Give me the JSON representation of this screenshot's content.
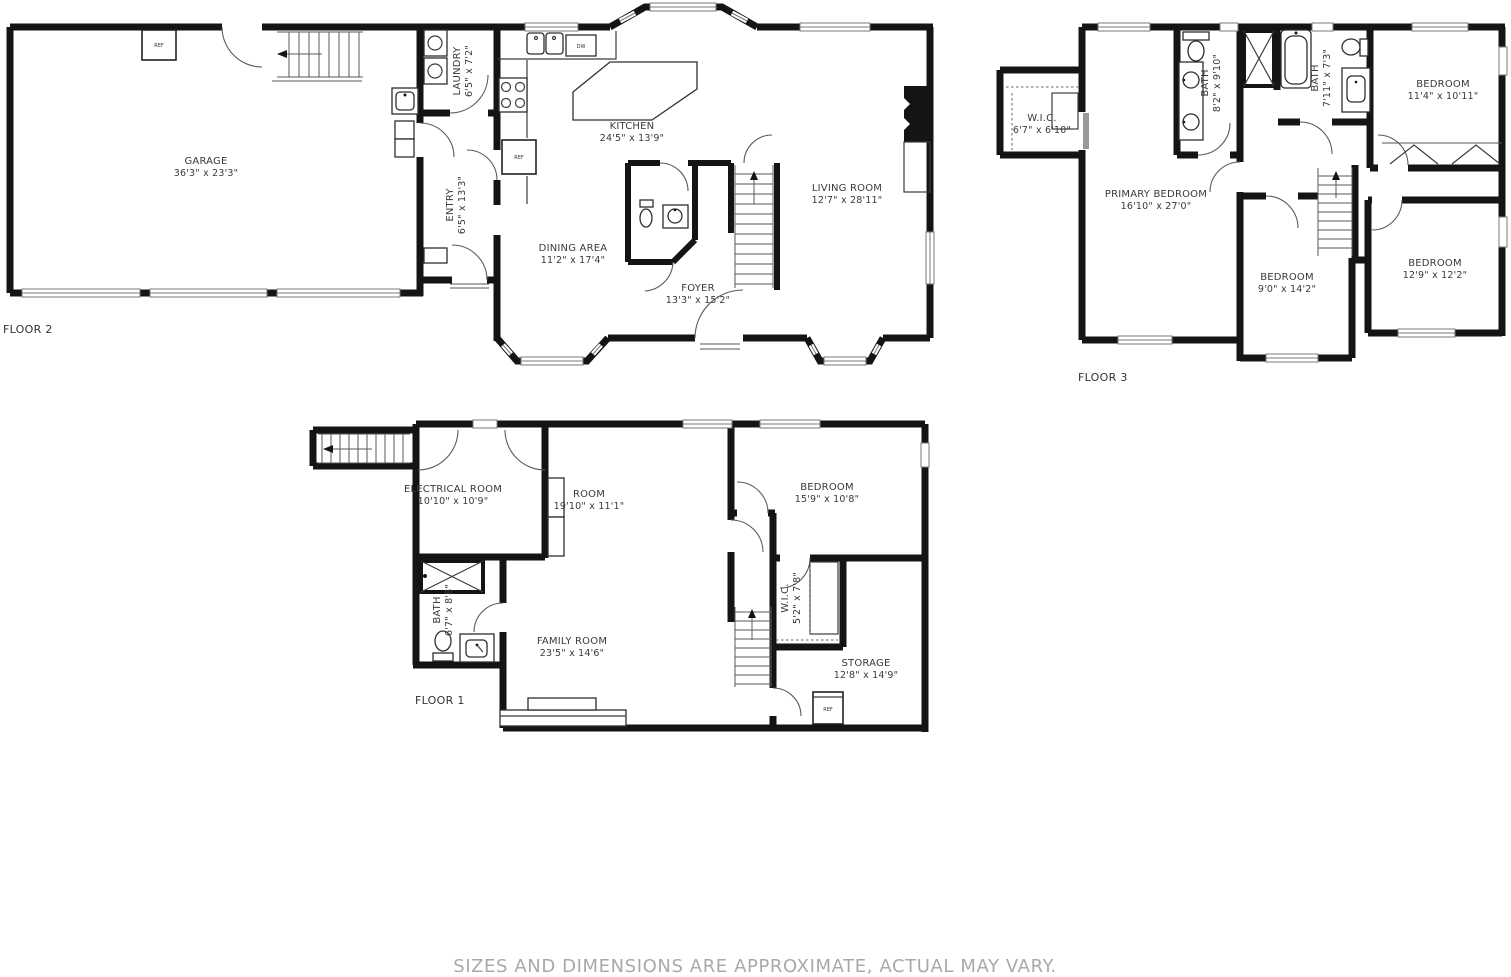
{
  "disclaimer": "SIZES AND DIMENSIONS ARE APPROXIMATE, ACTUAL MAY VARY.",
  "fixtures": {
    "refrigerator": "REF",
    "dishwasher": "DW"
  },
  "floors": [
    {
      "label": "FLOOR 2",
      "rooms": [
        {
          "name": "GARAGE",
          "dims": "36'3\" x 23'3\""
        },
        {
          "name": "LAUNDRY",
          "dims": "6'5\" x 7'2\""
        },
        {
          "name": "ENTRY",
          "dims": "6'5\" x 13'3\""
        },
        {
          "name": "KITCHEN",
          "dims": "24'5\" x 13'9\""
        },
        {
          "name": "DINING AREA",
          "dims": "11'2\" x 17'4\""
        },
        {
          "name": "FOYER",
          "dims": "13'3\" x 15'2\""
        },
        {
          "name": "LIVING ROOM",
          "dims": "12'7\" x 28'11\""
        }
      ]
    },
    {
      "label": "FLOOR 3",
      "rooms": [
        {
          "name": "W.I.C.",
          "dims": "6'7\" x 6'10\""
        },
        {
          "name": "BATH",
          "dims": "8'2\" x 9'10\""
        },
        {
          "name": "BATH",
          "dims": "7'11\" x 7'3\""
        },
        {
          "name": "BEDROOM",
          "dims": "11'4\" x 10'11\""
        },
        {
          "name": "PRIMARY BEDROOM",
          "dims": "16'10\" x 27'0\""
        },
        {
          "name": "BEDROOM",
          "dims": "9'0\" x 14'2\""
        },
        {
          "name": "BEDROOM",
          "dims": "12'9\" x 12'2\""
        }
      ]
    },
    {
      "label": "FLOOR 1",
      "rooms": [
        {
          "name": "ELECTRICAL ROOM",
          "dims": "10'10\" x 10'9\""
        },
        {
          "name": "ROOM",
          "dims": "19'10\" x 11'1\""
        },
        {
          "name": "BEDROOM",
          "dims": "15'9\" x 10'8\""
        },
        {
          "name": "BATH",
          "dims": "6'7\" x 8'8\""
        },
        {
          "name": "FAMILY ROOM",
          "dims": "23'5\" x 14'6\""
        },
        {
          "name": "W.I.C.",
          "dims": "5'2\" x 7'8\""
        },
        {
          "name": "STORAGE",
          "dims": "12'8\" x 14'9\""
        }
      ]
    }
  ]
}
